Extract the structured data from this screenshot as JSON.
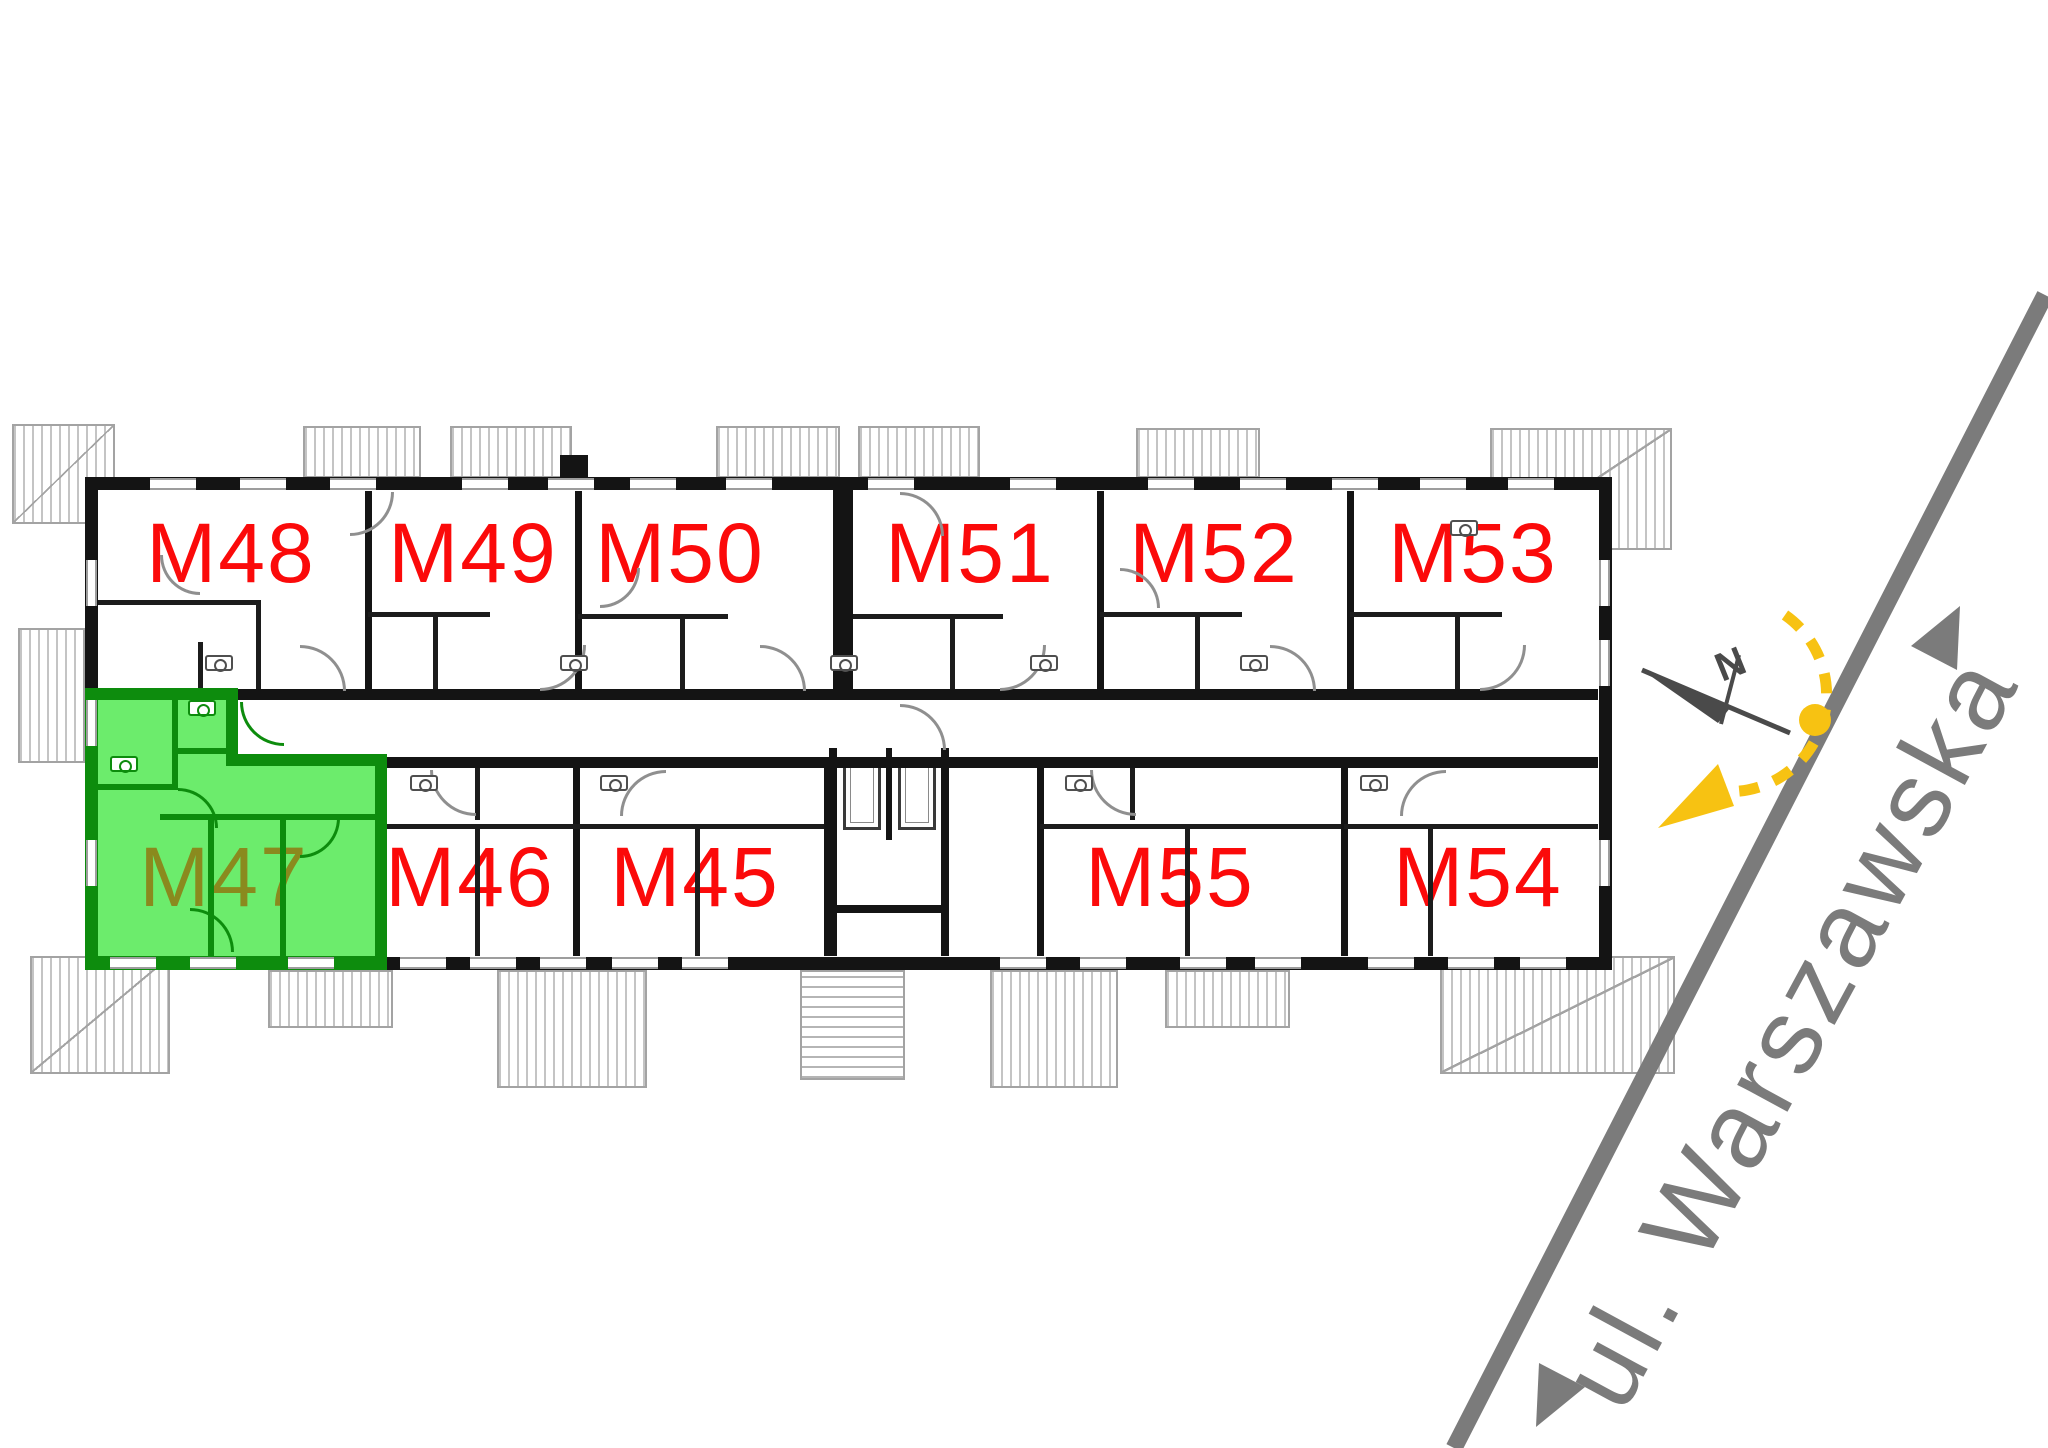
{
  "plan": {
    "type": "apartment-building-floor-plan",
    "street": {
      "label": "ul. Warszawska"
    },
    "compass": {
      "north": "N"
    },
    "highlighted_apartment": "M47",
    "apartments": {
      "top": [
        {
          "id": "M48"
        },
        {
          "id": "M49"
        },
        {
          "id": "M50"
        },
        {
          "id": "M51"
        },
        {
          "id": "M52"
        },
        {
          "id": "M53"
        }
      ],
      "bottom": [
        {
          "id": "M47",
          "highlighted": true
        },
        {
          "id": "M46"
        },
        {
          "id": "M45"
        },
        {
          "id": "M55"
        },
        {
          "id": "M54"
        }
      ]
    },
    "colors": {
      "label": "#fb0a0a",
      "highlight_fill": "#6cec6c",
      "highlight_wall": "#0d8c0d",
      "highlight_label": "#8a8a1e",
      "street": "#7b7b7b",
      "sun": "#f7c212",
      "wall": "#141414"
    }
  }
}
